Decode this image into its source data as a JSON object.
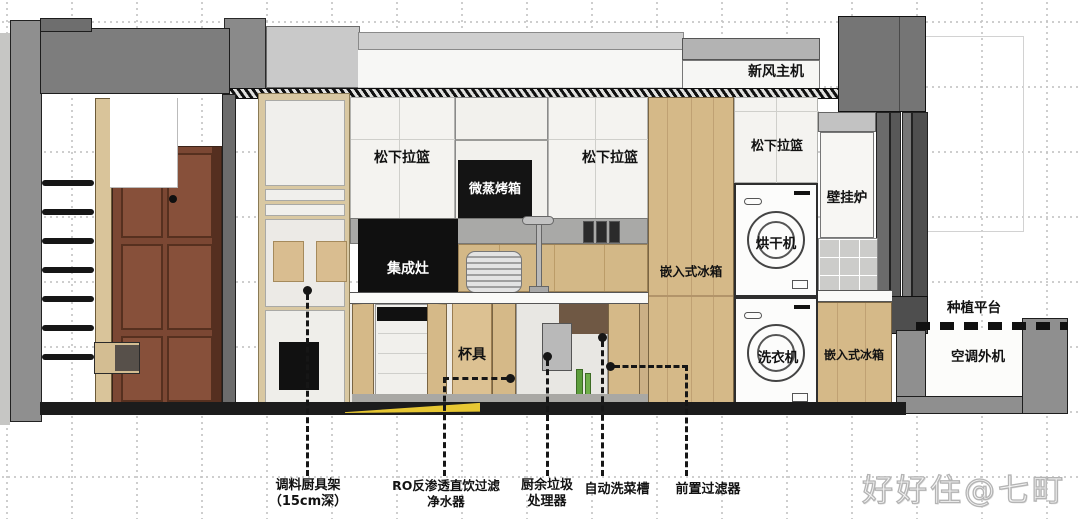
{
  "scene": {
    "type": "interior-section-elevation",
    "description": "apartment kitchen / laundry section drawing"
  },
  "labels": {
    "fresh_air_unit": "新风主机",
    "pullout_basket_upper_left": "松下拉篮",
    "pullout_basket_upper_right": "松下拉篮",
    "pullout_basket_laundry": "松下拉篮",
    "micro_steam_oven": "微蒸烤箱",
    "integrated_stove": "集成灶",
    "built_in_fridge_tall": "嵌入式冰箱",
    "built_in_fridge_under_counter": "嵌入式冰箱",
    "dryer": "烘干机",
    "washer": "洗衣机",
    "wall_hung_boiler": "壁挂炉",
    "cupware": "杯具",
    "planting_platform": "种植平台",
    "ac_outdoor_unit": "空调外机"
  },
  "callouts": [
    {
      "line1": "调料厨具架",
      "line2": "（15cm深）"
    },
    {
      "line1": "RO反渗透直饮过滤",
      "line2": "净水器"
    },
    {
      "line1": "厨余垃圾",
      "line2": "处理器"
    },
    {
      "line1": "自动洗菜槽",
      "line2": ""
    },
    {
      "line1": "前置过滤器",
      "line2": ""
    }
  ],
  "watermark": "好好住@七町",
  "colors": {
    "wood": "#d5b988",
    "floor": "#1c1c1c",
    "highlight_yellow": "#e7c733"
  }
}
